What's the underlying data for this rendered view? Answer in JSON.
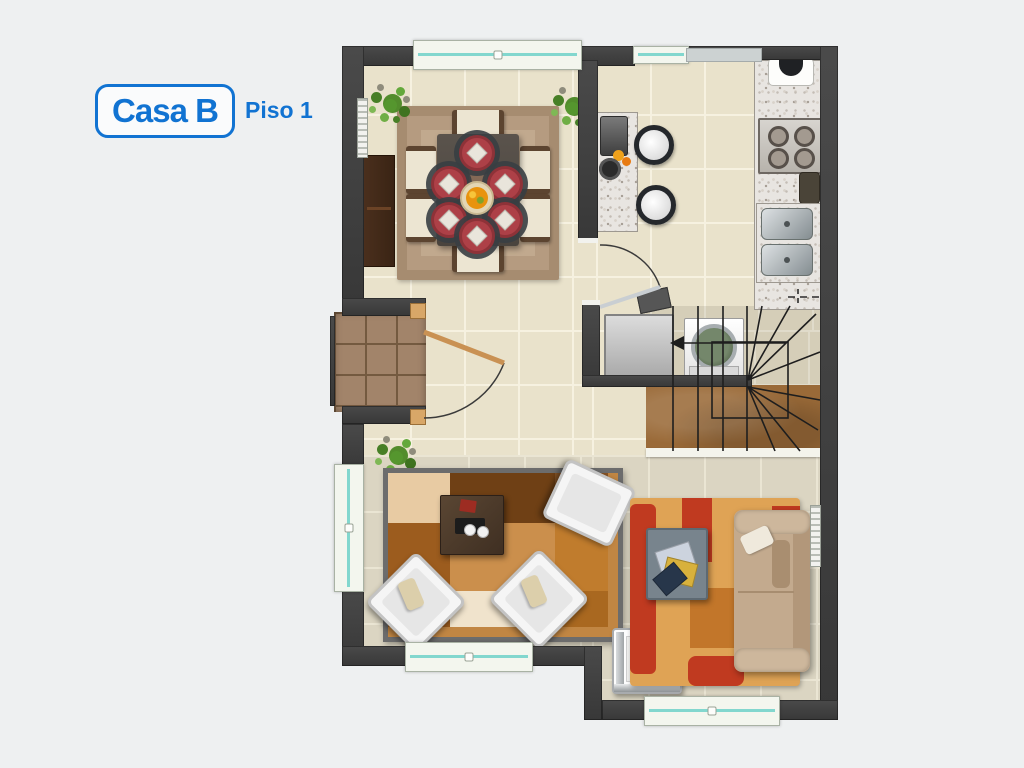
{
  "header": {
    "house_label": "Casa B",
    "floor_label": "Piso 1",
    "accent_color": "#1173d2"
  },
  "plan": {
    "type": "floor-plan",
    "rooms_depicted": [
      "comedor",
      "cocina",
      "lavanderia",
      "escalera",
      "entrada",
      "sala"
    ],
    "colors": {
      "page_background": "#eef0f1",
      "wall": "#3f3f3f",
      "floor_tile_warm": "#e9e2cb",
      "floor_tile_cool": "#dbd5c2",
      "porch_tile": "#a2846a",
      "window_glass": "#82d7ce",
      "window_frame": "#f3f6ee",
      "stair_wood": "#9a6a38",
      "dining_rug": "#b59b80",
      "plate_red": "#ad4047",
      "sofa_tan": "#c3aa8e",
      "orange_rug": "#dfa355",
      "rug_red_accent": "#c03a20",
      "granite": "#e8e5e1",
      "plant_green": "#55962e"
    }
  }
}
